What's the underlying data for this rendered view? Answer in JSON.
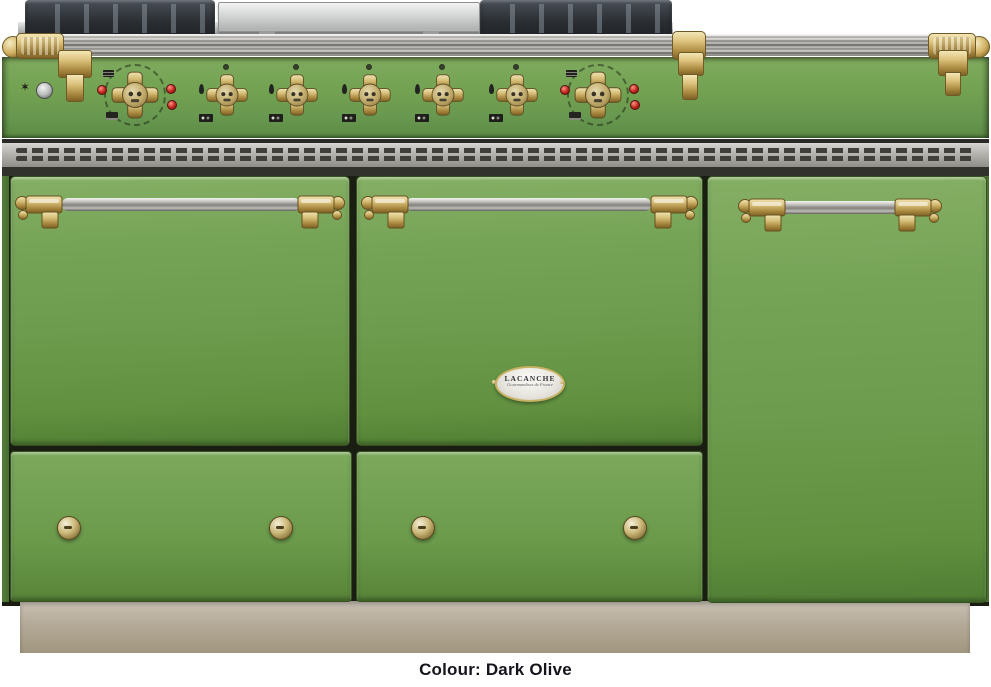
{
  "caption": {
    "text": "Colour: Dark Olive"
  },
  "appliance": {
    "type": "range-cooker-product-photo",
    "badge": {
      "brand": "LACANCHE",
      "tagline": "Gourmandises de France"
    },
    "colors": {
      "body_green": "#6d9c4e",
      "body_green_dark": "#4f7d33",
      "brass": "#c9ac5d",
      "stainless": "#b5b3ae",
      "grate_black": "#2b2f34",
      "plinth_beige": "#b4aa98",
      "indicator_red": "#c22620",
      "chassis_dark": "#191d12",
      "caption_text": "#14141c"
    },
    "cooktop": {
      "left_pan_support": "cast-iron-grate",
      "center": "stainless-griddle-plate",
      "right_pan_support": "cast-iron-grate",
      "towel_rail": "stainless-tube-with-brass-finials"
    },
    "control_panel": {
      "spark_icon": "✶",
      "ignition_button": "round-metal-button",
      "knobs": [
        {
          "kind": "oven-thermostat",
          "x": 135,
          "indicator_lights": 3
        },
        {
          "kind": "burner",
          "x": 227
        },
        {
          "kind": "burner",
          "x": 297
        },
        {
          "kind": "burner",
          "x": 370
        },
        {
          "kind": "burner",
          "x": 443
        },
        {
          "kind": "burner",
          "x": 517
        },
        {
          "kind": "oven-thermostat",
          "x": 598,
          "indicator_lights": 3
        }
      ]
    },
    "doors": [
      {
        "position": "left",
        "kind": "oven-door",
        "handle": "brass-and-stainless-rail"
      },
      {
        "position": "middle",
        "kind": "oven-door",
        "handle": "brass-and-stainless-rail",
        "badge": true
      },
      {
        "position": "right",
        "kind": "tall-cabinet-door",
        "handle": "brass-and-stainless-rail"
      }
    ],
    "drawers": [
      {
        "position": "left",
        "knob_x": [
          68,
          280
        ],
        "knob_y": 527
      },
      {
        "position": "middle",
        "knob_x": [
          422,
          634
        ],
        "knob_y": 527
      }
    ]
  }
}
